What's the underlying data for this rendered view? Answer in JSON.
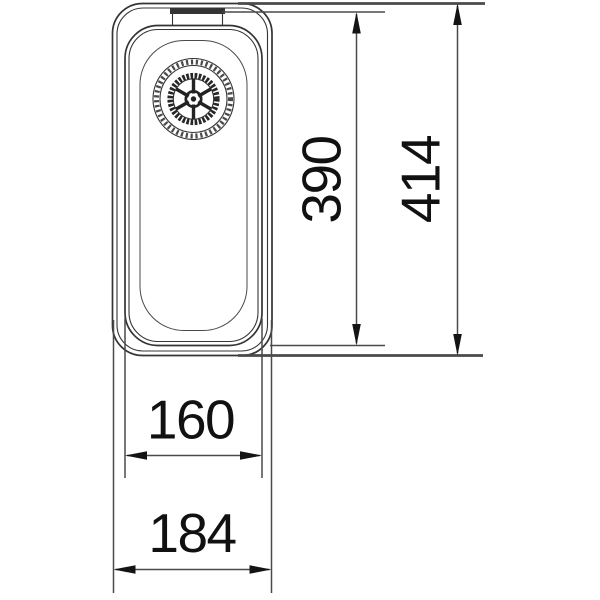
{
  "drawing": {
    "dimensions": {
      "inner_length_mm": "390",
      "outer_length_mm": "414",
      "inner_width_mm": "160",
      "outer_width_mm": "184"
    },
    "colors": {
      "line": "#343434",
      "thin_line": "#4a4a4a",
      "arrow": "#141414",
      "text": "#111111",
      "bg": "#ffffff"
    }
  }
}
